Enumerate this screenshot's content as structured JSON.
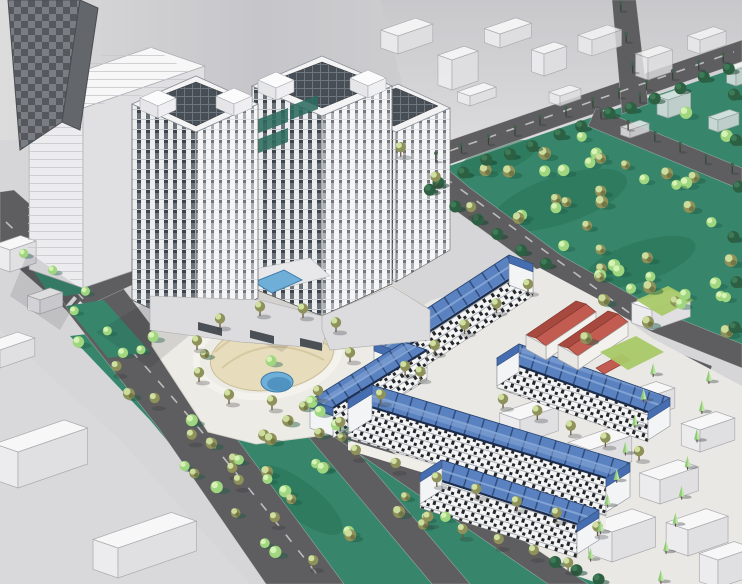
{
  "meta": {
    "title": "Aerial architectural rendering of a mixed residential development",
    "render_style": "3D massing visualization"
  },
  "scene": {
    "type": "aerial-architectural-rendering",
    "subject": "residential master plan with twin towers, townhouse rows, parks and roads",
    "elements": {
      "highrise_towers": "white high-rise apartment towers with dark window strips, rooftop panel grids and teal glass accents",
      "townhouse_rows": "rows of low-rise townhouses with blue mansard roofs and dark checkered facades",
      "red_roof_buildings": "low community buildings with red hipped roofs and white walls",
      "central_plaza": "oval landscaped plaza with sand-colored ground, curved paths and a small pond",
      "swimming_pool": "rectangular blue pool at the tower podium",
      "parks": "teal green parks densely planted with olive and light-green trees",
      "context_buildings": "translucent white massing-model context buildings",
      "roads": "dark gray boulevards with medians, crosswalks and street trees"
    },
    "counts": {
      "towers": 3,
      "townhouse_rows": 5,
      "red_roof_buildings": 2
    }
  },
  "palette": {
    "grass": "#37866B",
    "grass_dark": "#2A7258",
    "tree_olive": "#8E9159",
    "tree_olive_light": "#CFE0A0",
    "tree_light": "#9FD67F",
    "tree_light_hl": "#D6F2B4",
    "tree_dark": "#2D5F42",
    "tree_cone": "#B9E59C",
    "roof_blue": "#5B82C0",
    "roof_blue_light": "#86A7D6",
    "roof_blue_dark": "#24406E",
    "gable_blue": "#466DB0",
    "roof_red": "#C25B50",
    "roof_red_dark": "#A8493F",
    "pool": "#6FAED6",
    "pond_dark": "#3C7FB0",
    "road": "#5E5E60",
    "ground": "#D6D6D8",
    "ground_dark": "#C4C4C8",
    "ground_light": "#E9E9EA",
    "paving": "#E9E8E4",
    "apron": "#EDEBE5",
    "sand": "#E7DCBC",
    "sand_line": "#D6C9A2",
    "facade": "#F5F5F6",
    "window": "#3A4046",
    "teal_glass": "#2E6B5E",
    "lawn": "#A9C968",
    "sketch_top": "#F7F7F8",
    "sketch_left": "#ECECEE",
    "sketch_right": "#E0E0E3",
    "sketch_stroke": "#ABABAF",
    "slab_dark": "#55595E",
    "slab_mid": "#7A7E84"
  }
}
